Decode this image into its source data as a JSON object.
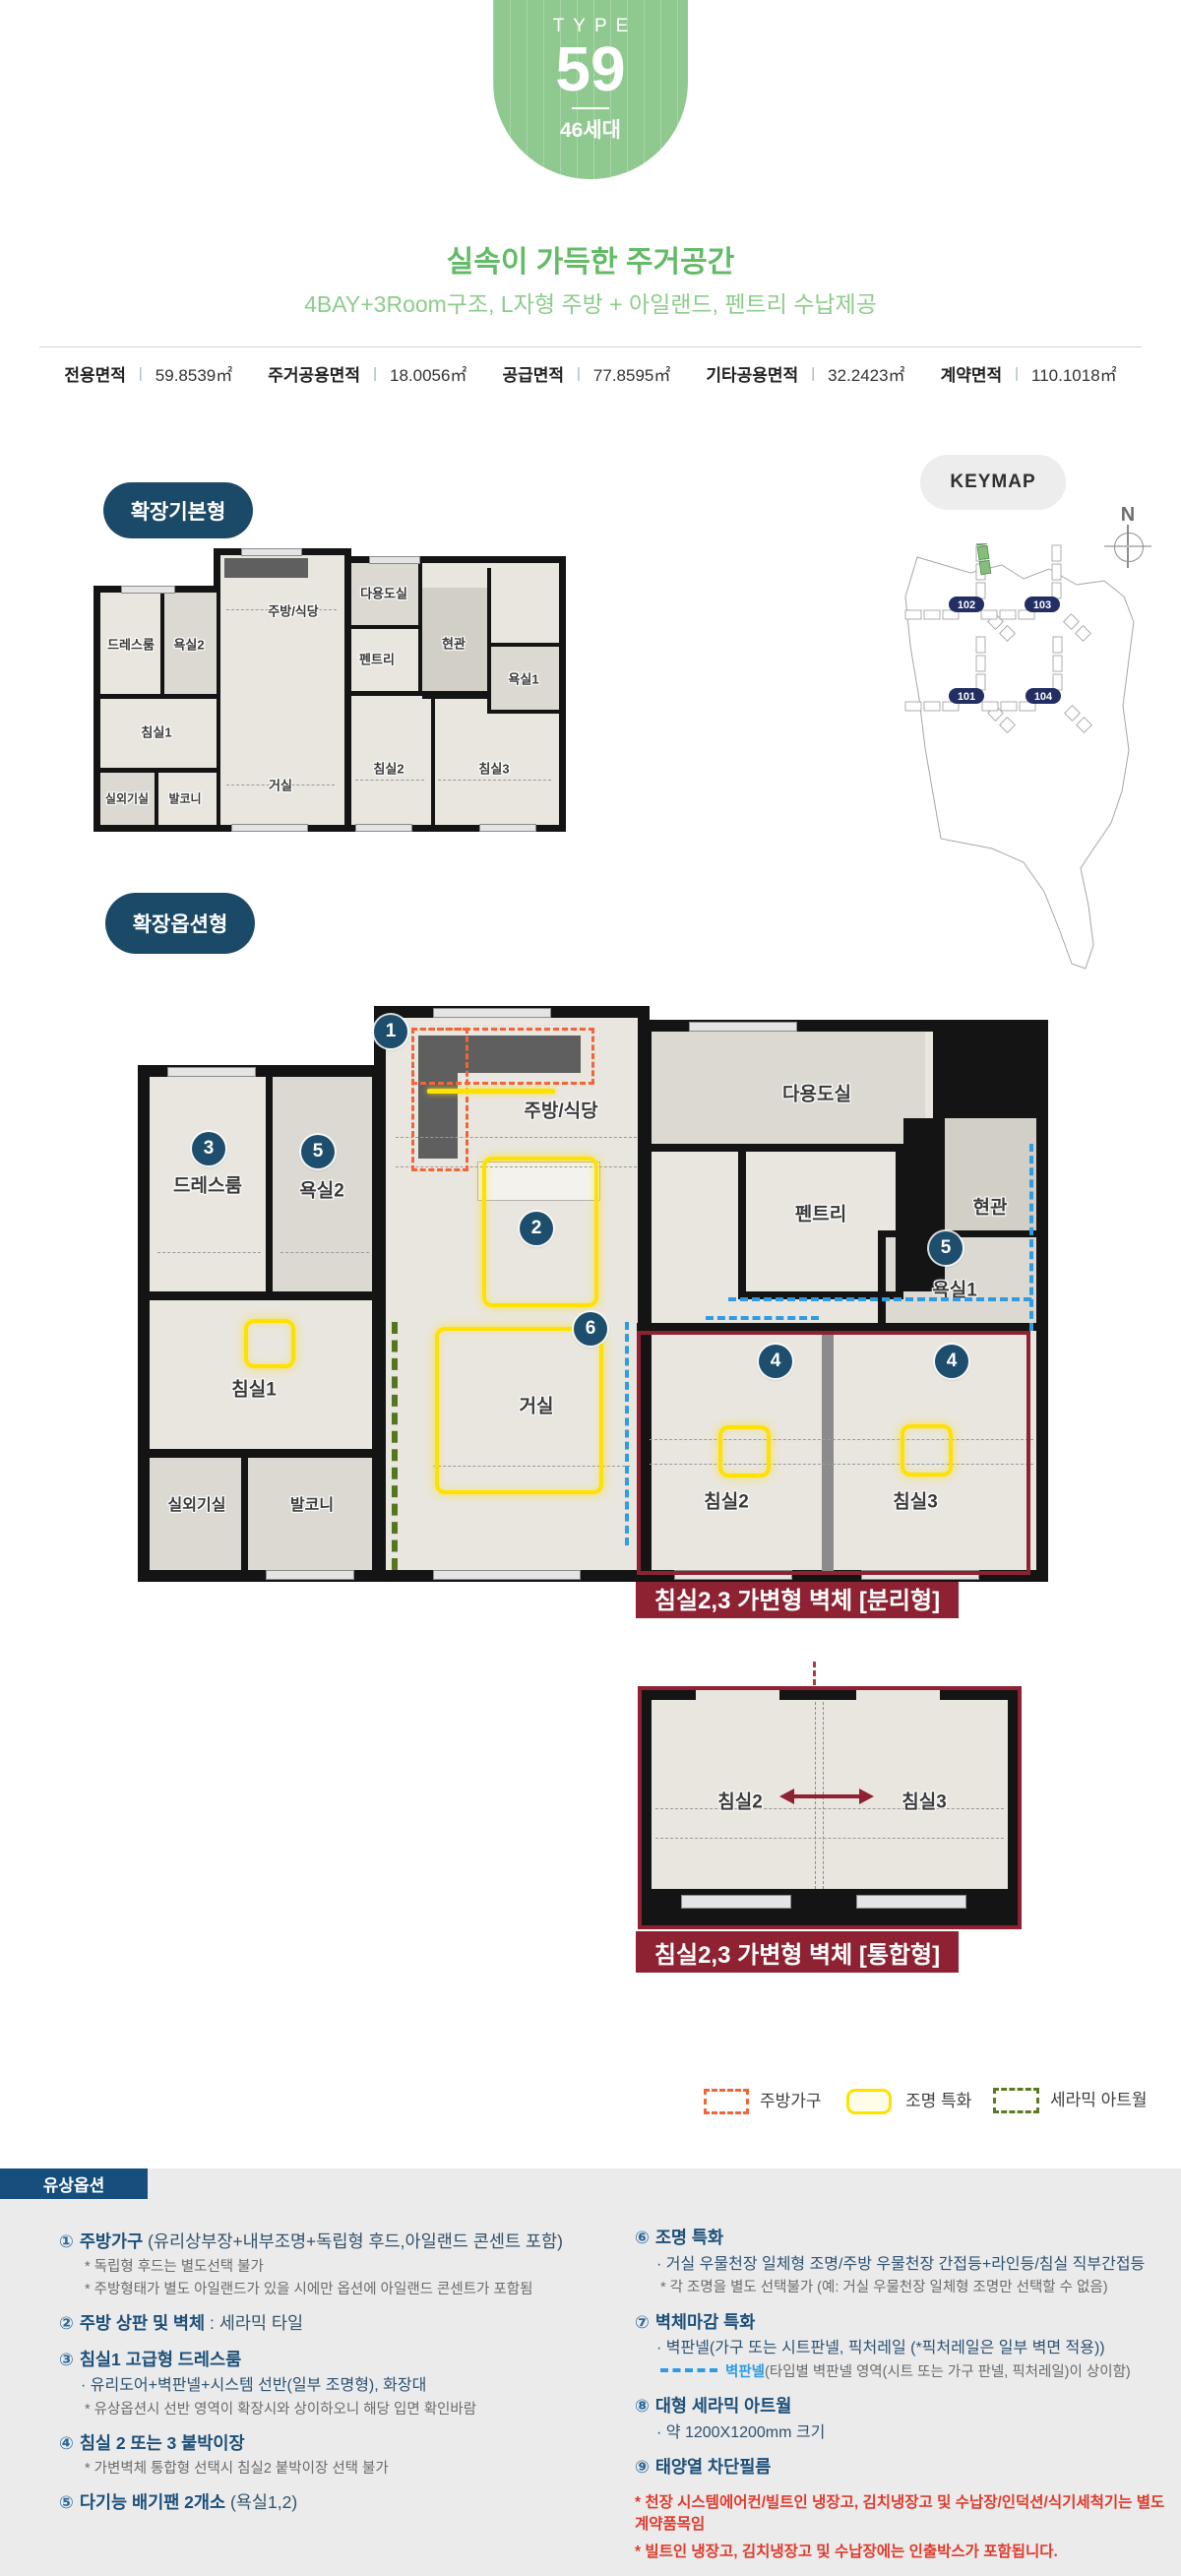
{
  "type_badge": {
    "label": "TYPE",
    "number": "59",
    "units": "46세대"
  },
  "header": {
    "title": "실속이 가득한 주거공간",
    "subtitle": "4BAY+3Room구조, L자형 주방 + 아일랜드, 펜트리 수납제공"
  },
  "area_info": {
    "items": [
      {
        "label": "전용면적",
        "sep": "|",
        "value": "59.8539㎡"
      },
      {
        "label": "주거공용면적",
        "sep": "|",
        "value": "18.0056㎡"
      },
      {
        "label": "공급면적",
        "sep": "|",
        "value": "77.8595㎡"
      },
      {
        "label": "기타공용면적",
        "sep": "|",
        "value": "32.2423㎡"
      },
      {
        "label": "계약면적",
        "sep": "|",
        "value": "110.1018㎡"
      }
    ]
  },
  "basic_plan": {
    "badge": "확장기본형"
  },
  "option_plan": {
    "badge": "확장옵션형",
    "separate_caption": "침실2,3 가변형 벽체 [분리형]",
    "merged_caption": "침실2,3 가변형 벽체 [통합형]"
  },
  "rooms": {
    "kitchen": "주방/식당",
    "utility": "다용도실",
    "pantry": "펜트리",
    "entrance": "현관",
    "bath1": "욕실1",
    "bath2": "욕실2",
    "dress": "드레스룸",
    "bed1": "침실1",
    "living": "거실",
    "bed2": "침실2",
    "bed3": "침실3",
    "outdoor_unit": "실외기실",
    "balcony": "발코니"
  },
  "markers": {
    "m1": "1",
    "m2": "2",
    "m3": "3",
    "m4": "4",
    "m5": "5",
    "m6": "6"
  },
  "keymap": {
    "label": "KEYMAP",
    "north": "N",
    "blocks": {
      "b101": "101",
      "b102": "102",
      "b103": "103",
      "b104": "104"
    }
  },
  "legend": {
    "kitchen_furniture": "주방가구",
    "lighting": "조명 특화",
    "ceramic": "세라믹 아트월"
  },
  "options": {
    "title": "유상옵션",
    "left": [
      {
        "num": "①",
        "title": "주방가구",
        "suffix": "(유리상부장+내부조명+독립형 후드,아일랜드 콘센트  포함)",
        "notes": [
          "* 독립형 후드는 별도선택 불가",
          "* 주방형태가 별도 아일랜드가 있을 시에만 옵션에 아일랜드 콘센트가 포함됨"
        ]
      },
      {
        "num": "②",
        "title": "주방 상판 및 벽체",
        "suffix": ": 세라믹 타일"
      },
      {
        "num": "③",
        "title": "침실1 고급형 드레스룸",
        "bullet": "· 유리도어+벽판넬+시스템 선반(일부 조명형), 화장대",
        "notes": [
          "* 유상옵션시 선반 영역이 확장시와 상이하오니 해당 입면 확인바람"
        ]
      },
      {
        "num": "④",
        "title": "침실 2 또는 3 붙박이장",
        "notes": [
          "* 가변벽체 통합형 선택시 침실2 붙박이장 선택 불가"
        ]
      },
      {
        "num": "⑤",
        "title": "다기능 배기팬 2개소",
        "suffix": "(욕실1,2)"
      }
    ],
    "right": [
      {
        "num": "⑥",
        "title": "조명 특화",
        "bullet": "· 거실 우물천장 일체형 조명/주방 우물천장 간접등+라인등/침실 직부간접등",
        "notes": [
          "* 각 조명을 별도 선택불가 (예: 거실 우물천장 일체형 조명만 선택할 수 없음)"
        ]
      },
      {
        "num": "⑦",
        "title": "벽체마감 특화",
        "bullet": "· 벽판넬(가구 또는 시트판넬, 픽처레일 (*픽처레일은 일부 벽면 적용))",
        "panel_label": "벽판넬",
        "panel_note": "(타입별 벽판넬 영역(시트 또는 가구 판넬, 픽처레일)이 상이함)"
      },
      {
        "num": "⑧",
        "title": "대형 세라믹 아트월",
        "bullet": "· 약 1200X1200mm 크기"
      },
      {
        "num": "⑨",
        "title": "태양열 차단필름"
      }
    ],
    "red_notes": [
      "* 천장 시스템에어컨/빌트인 냉장고, 김치냉장고 및 수납장/인덕션/식기세척기는 별도 계약품목임",
      "* 빌트인 냉장고, 김치냉장고 및 수납장에는 인출박스가 포함됩니다."
    ]
  },
  "colors": {
    "accent_green": "#8fc98f",
    "navy": "#1b4a68",
    "maroon": "#8e2132",
    "lighting_yellow": "#ffe100",
    "kitchen_orange": "#f2653a",
    "ceramic_olive": "#5b7a20",
    "panel_blue": "#2f9be0",
    "red_note": "#de3b2e"
  }
}
